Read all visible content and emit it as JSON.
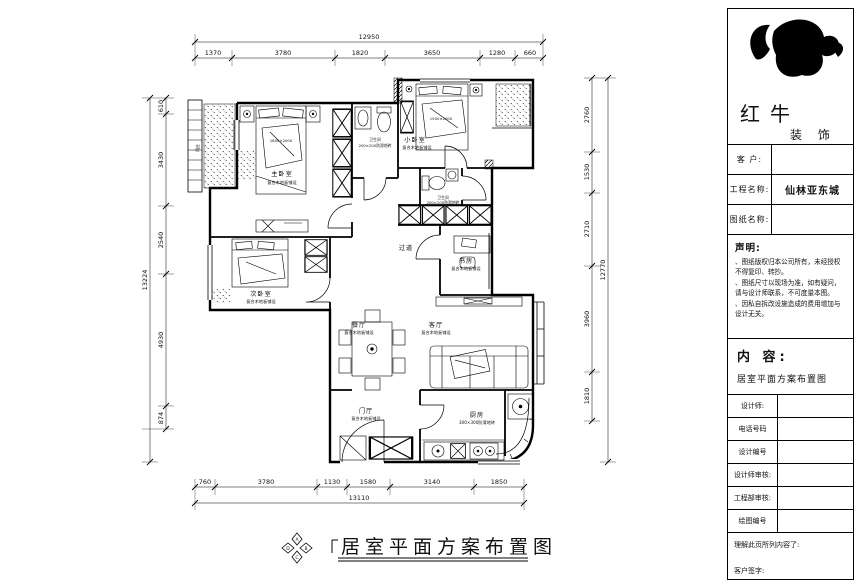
{
  "brand": {
    "line1": "红牛",
    "line2": "装 饰"
  },
  "titleblock": {
    "fields": [
      {
        "label": "客  户:",
        "value": ""
      },
      {
        "label": "工程名称:",
        "value": "仙林亚东城"
      },
      {
        "label": "图纸名称:",
        "value": ""
      }
    ],
    "statement_heading": "声明:",
    "statement_items": [
      "图纸版权归本公司所有，未经授权不得复印、转抄。",
      "图纸尺寸以现场为准，如有疑问，请与设计师联系，不可度量本图。",
      "因私自拆改设施造成的费用增加与设计无关。"
    ],
    "content_heading": "内 容:",
    "content_value": "居室平面方案布置图",
    "sign_rows": [
      "设计师:",
      "电话号码",
      "设计编号",
      "设计师审核:",
      "工程部审核:",
      "绘图编号"
    ],
    "footer_line1": "理解此页所列内容了:",
    "footer_line2": "客户签字:"
  },
  "caption": "居室平面方案布置图",
  "compass": {
    "n": "A",
    "e": "B",
    "s": "C",
    "w": "D"
  },
  "dims": {
    "top_total": "12950",
    "top": [
      "1370",
      "3780",
      "1820",
      "3650",
      "1280",
      "660"
    ],
    "bottom": [
      "760",
      "3780",
      "1130",
      "1580",
      "3140",
      "1850"
    ],
    "bottom_total": "13110",
    "left": [
      "610",
      "3430",
      "2540",
      "4930",
      "874"
    ],
    "left_total": "13224",
    "right": [
      "2760",
      "1530",
      "2710",
      "3960",
      "1810"
    ],
    "right_total": "12770"
  },
  "rooms": {
    "master": {
      "name": "主卧室",
      "finish": "复合木地板铺设",
      "bed": "1800×2000"
    },
    "second": {
      "name": "次卧室",
      "finish": "复合木地板铺设"
    },
    "small": {
      "name": "小卧室",
      "finish": "复合木地板铺设",
      "bed": "1500×2000"
    },
    "study": {
      "name": "书房",
      "finish": "复合木地板铺设"
    },
    "dining": {
      "name": "餐厅",
      "finish": "复合木地板铺设"
    },
    "living": {
      "name": "客厅",
      "finish": "复合木地板铺设"
    },
    "entry": {
      "name": "门厅",
      "finish": "复合木地板铺设"
    },
    "kitchen": {
      "name": "厨房",
      "finish": "300×300防滑地砖"
    },
    "bath1": {
      "name": "卫生间",
      "finish": "200×200防滑地砖"
    },
    "bath2": {
      "name": "卫生间",
      "finish": "200×200防滑地砖"
    },
    "corridor": {
      "name": "过道"
    },
    "balcony": {
      "name": "阳台"
    }
  }
}
